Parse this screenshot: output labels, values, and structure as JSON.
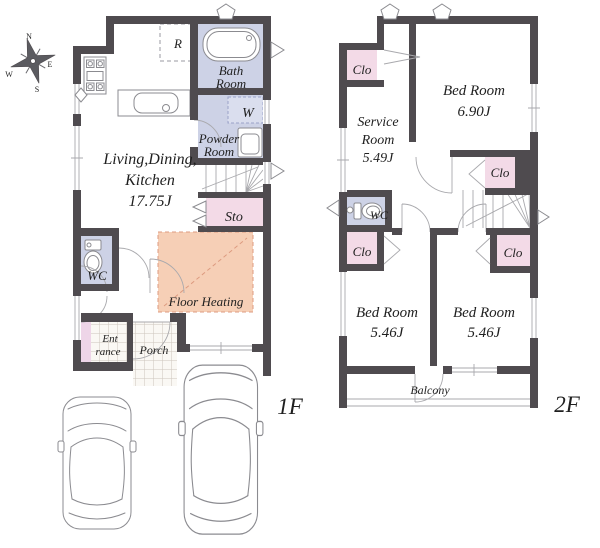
{
  "compass": {
    "n": "N",
    "e": "E",
    "s": "S",
    "w": "W"
  },
  "floor1": {
    "label": "1F",
    "living_line1": "Living,Dining,",
    "living_line2": "Kitchen",
    "living_size": "17.75J",
    "refrigerator": "R",
    "bath_line1": "Bath",
    "bath_line2": "Room",
    "washer": "W",
    "powder_line1": "Powder",
    "powder_line2": "Room",
    "storage": "Sto",
    "wc": "WC",
    "floor_heating": "Floor Heating",
    "entrance_line1": "Ent",
    "entrance_line2": "rance",
    "porch": "Porch"
  },
  "floor2": {
    "label": "2F",
    "bedroom_main_name": "Bed Room",
    "bedroom_main_size": "6.90J",
    "service_line1": "Service",
    "service_line2": "Room",
    "service_size": "5.49J",
    "bedroom_sw_name": "Bed Room",
    "bedroom_sw_size": "5.46J",
    "bedroom_se_name": "Bed Room",
    "bedroom_se_size": "5.46J",
    "wc": "WC",
    "closet": "Clo",
    "balcony": "Balcony"
  },
  "colors": {
    "wall": "#4f4b4f",
    "wet_area": "#cdd2e6",
    "washer_area": "#dadeee",
    "closet": "#f3dae7",
    "entrance_cabinet": "#eed5e8",
    "floor_heating_fill": "#f6cfb6",
    "floor_heating_border": "#dd9b80",
    "fixture_line": "#8b8b90",
    "text": "#1f1f1f"
  }
}
